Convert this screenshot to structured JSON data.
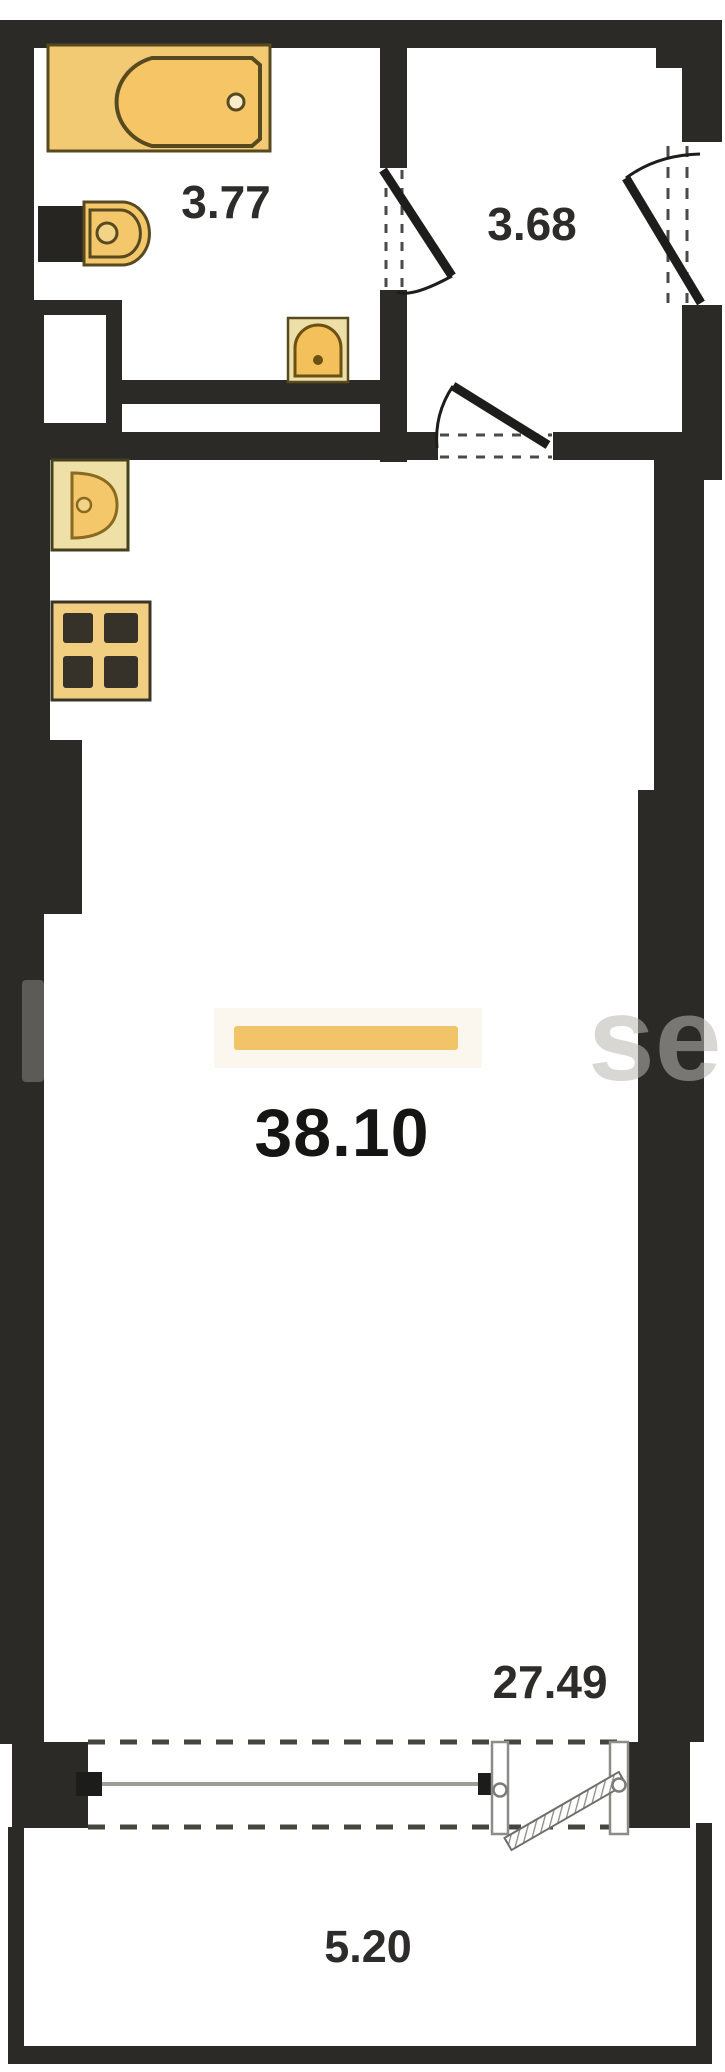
{
  "rooms": {
    "bathroom": {
      "area": "3.77"
    },
    "hallway": {
      "area": "3.68"
    },
    "living_room": {
      "area": "38.10"
    },
    "living_room_zone": {
      "area": "27.49"
    },
    "balcony": {
      "area": "5.20"
    }
  },
  "fixtures": [
    {
      "icon": "bathtub-icon"
    },
    {
      "icon": "toilet-icon"
    },
    {
      "icon": "washbasin-icon"
    },
    {
      "icon": "kitchen-sink-icon"
    },
    {
      "icon": "stove-icon"
    }
  ],
  "watermark_fragment": "se",
  "colors": {
    "wall": "#2b2a27",
    "fixture_fill": "#f5c76b",
    "fixture_border": "#584a20",
    "area_highlight_bar": "#f2c469",
    "dimension_text": "#2d2c2a",
    "window_line": "#9c9c98"
  }
}
